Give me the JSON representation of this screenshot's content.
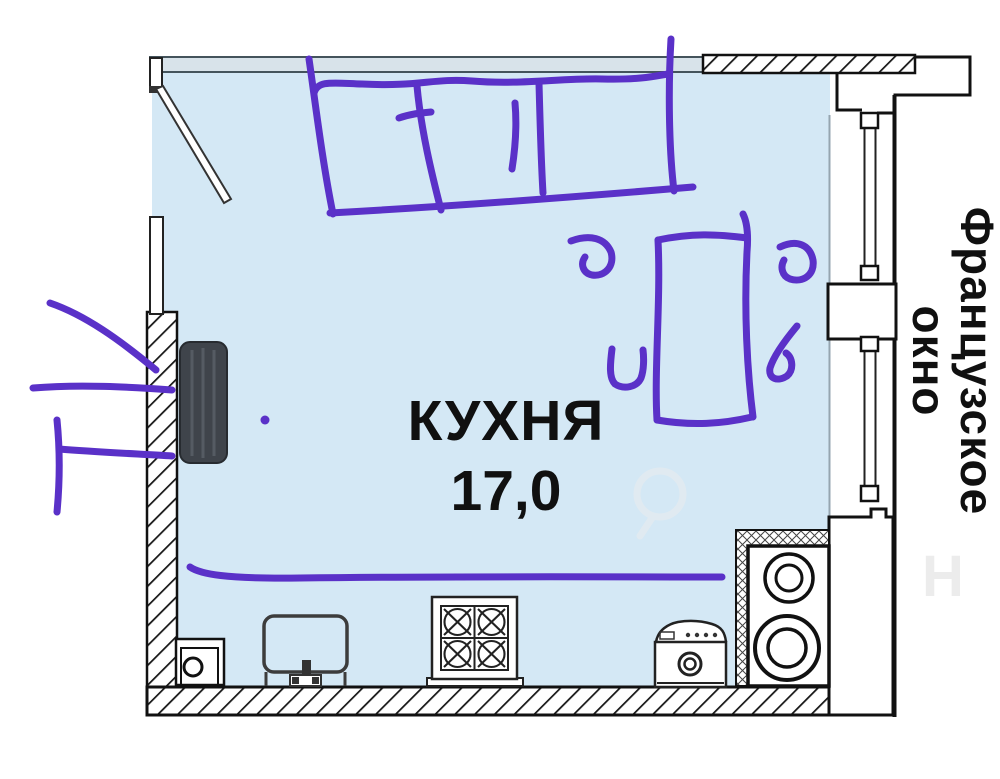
{
  "labels": {
    "room_name": "КУХНЯ",
    "room_area": "17,0",
    "window_line1": "Французское",
    "window_line2": "окно"
  },
  "colors": {
    "room_fill": "#d4e8f5",
    "wall_band_fill": "#d8e3ea",
    "annotation": "#5a31c8",
    "line": "#161616",
    "text": "#101010"
  }
}
